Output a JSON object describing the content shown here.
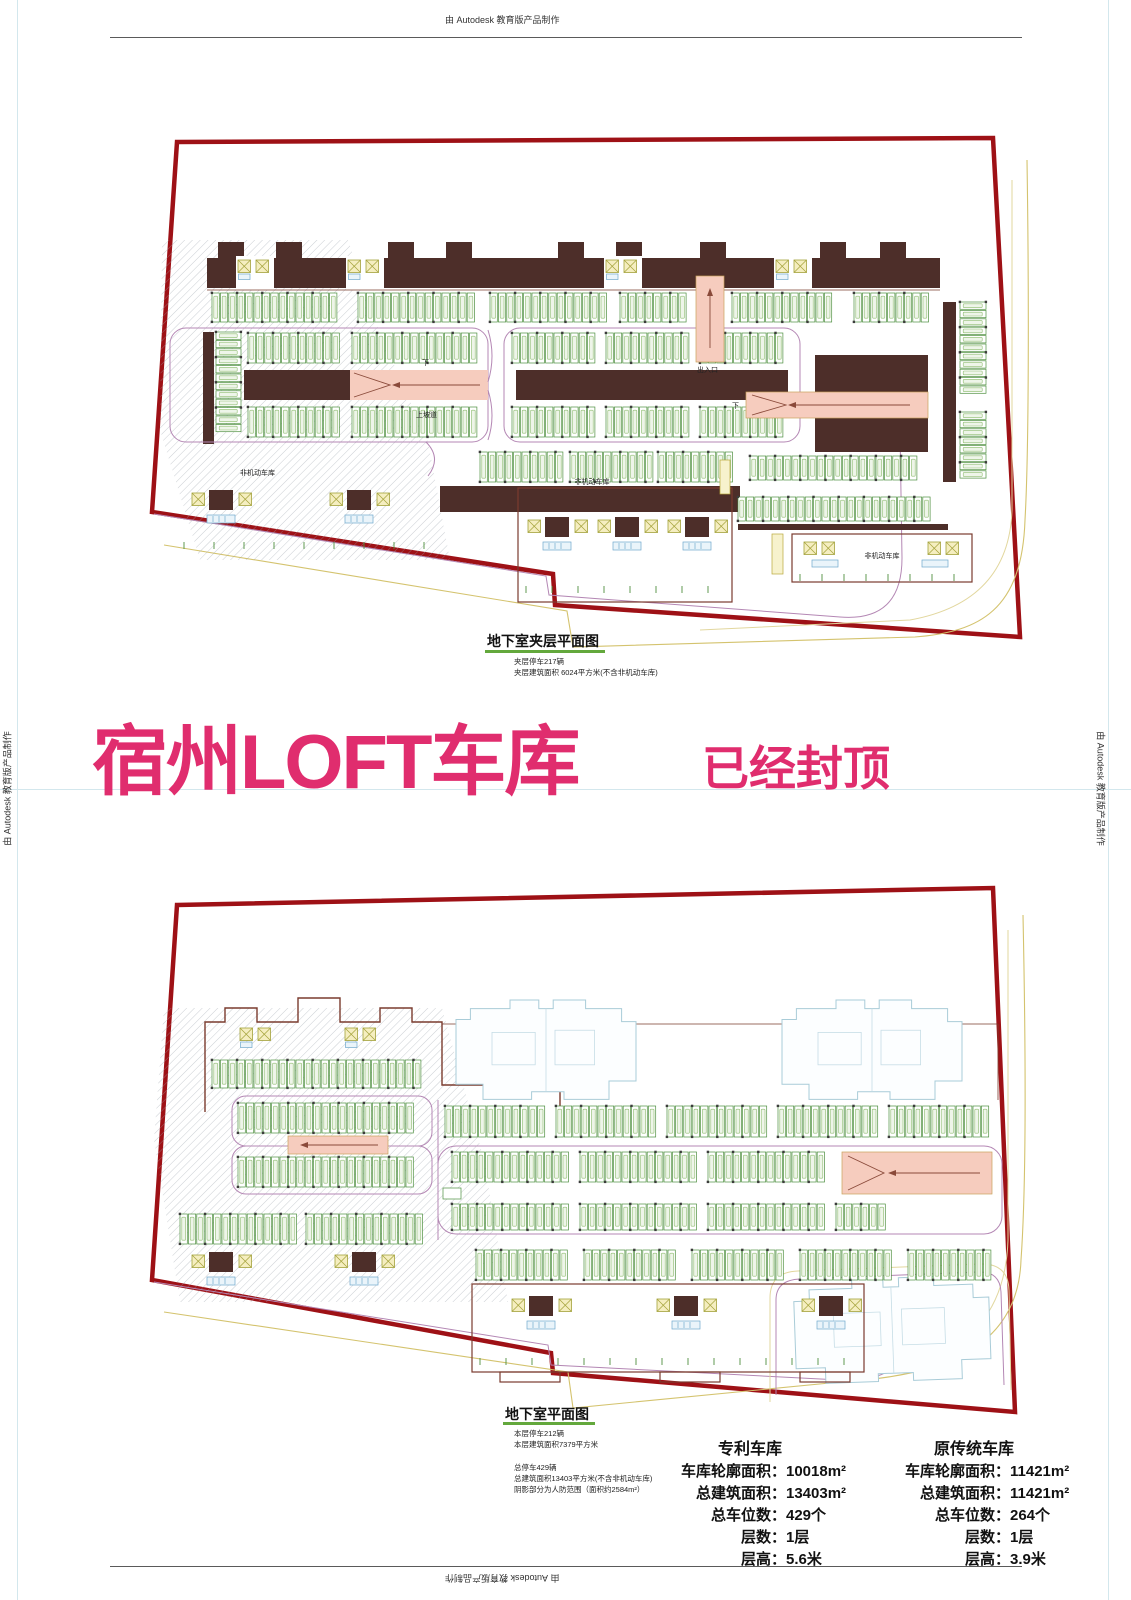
{
  "watermark": {
    "text": "由 Autodesk 教育版产品制作"
  },
  "headline": {
    "main": "宿州LOFT车库",
    "status": "已经封顶"
  },
  "sheet1": {
    "title": "地下室夹层平面图",
    "note1": "夹层停车217辆",
    "note2": "夹层建筑面积 6024平方米(不含非机动车库)",
    "labels": {
      "nm_left": "非机动车库",
      "nm_mid": "非机动车库",
      "nm_right": "非机动车库",
      "ramp_up": "上坡道",
      "down1": "下",
      "down2": "下",
      "entrance": "出入口"
    }
  },
  "sheet2": {
    "title": "地下室平面图",
    "note1": "本层停车212辆",
    "note2": "本层建筑面积7379平方米",
    "note3": "总停车429辆",
    "note4": "总建筑面积13403平方米(不含非机动车库)",
    "note5": "阴影部分为人防范围（面积约2584m²）"
  },
  "stats": {
    "patent": {
      "title": "专利车库",
      "rows": [
        {
          "label": "车库轮廓面积：",
          "value": "10018m²"
        },
        {
          "label": "总建筑面积：",
          "value": "13403m²"
        },
        {
          "label": "总车位数：",
          "value": "429个"
        },
        {
          "label": "层数：",
          "value": "1层"
        },
        {
          "label": "层高：",
          "value": "5.6米"
        }
      ]
    },
    "traditional": {
      "title": "原传统车库",
      "rows": [
        {
          "label": "车库轮廓面积：",
          "value": "11421m²"
        },
        {
          "label": "总建筑面积：",
          "value": "11421m²"
        },
        {
          "label": "总车位数：",
          "value": "264个"
        },
        {
          "label": "层数：",
          "value": "1层"
        },
        {
          "label": "层高：",
          "value": "3.9米"
        }
      ]
    }
  },
  "colors": {
    "boundary_red": "#9e1116",
    "aisle_brown": "#4d2e29",
    "stall_green": "#4e8f3f",
    "ramp_pink": "#f6ccbe",
    "lane_purple": "#b487b4",
    "site_yellow": "#d4c36e",
    "ghost_blue": "#a9ccd8",
    "title_pink": "#e02d6e",
    "underline_green": "#63a83c"
  }
}
